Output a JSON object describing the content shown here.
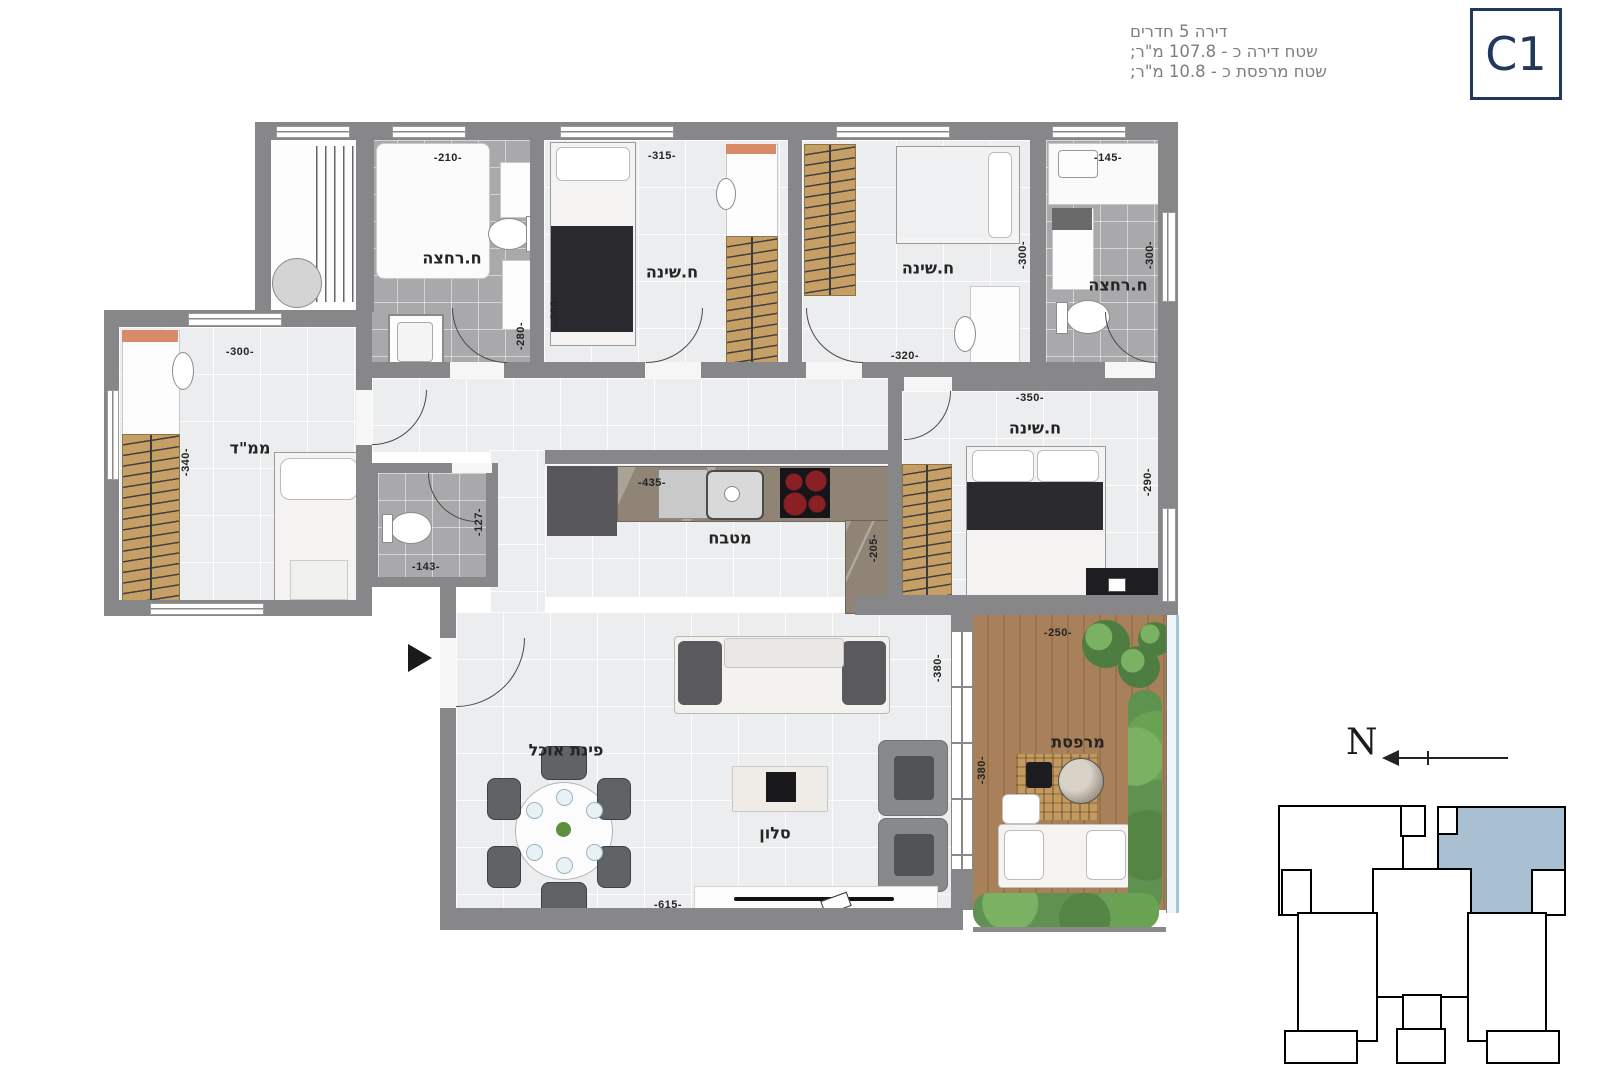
{
  "header": {
    "unit_code": "C1",
    "lines": [
      "דירה 5 חדרים",
      "שטח דירה כ - 107.8 מ\"ר;",
      "שטח מרפסת כ - 10.8 מ\"ר;"
    ]
  },
  "plan": {
    "room_labels": {
      "bath1": "ח.רחצה",
      "bed1": "ח.שינה",
      "bed2": "ח.שינה",
      "bath2": "ח.רחצה",
      "mamad": "ממ\"ד",
      "master": "ח.שינה",
      "kitchen": "מטבח",
      "dining": "פינת אוכל",
      "living": "סלון",
      "balcony": "מרפסת"
    },
    "dims": {
      "bath1_w": "-210-",
      "bath1_h": "-280-",
      "bed1_w": "-315-",
      "bed1_h": "-300-",
      "bed2_w": "-320-",
      "bed2_h": "-300-",
      "bath2_w": "-145-",
      "bath2_h": "-300-",
      "mamad_w": "-300-",
      "mamad_h": "-340-",
      "wc_w": "-143-",
      "wc_h": "-127-",
      "kitchen_w": "-435-",
      "kitchen_h": "-205-",
      "master_w": "-350-",
      "master_h": "-290-",
      "living_w": "-615-",
      "living_h": "-380-",
      "balcony_w": "-250-",
      "balcony_h": "-380-"
    },
    "compass": {
      "north_label": "N"
    }
  },
  "colors": {
    "wall": "#878789",
    "navy": "#21375d",
    "key_unit_fill": "#a9c0d2",
    "wood": "#c69f67",
    "deck": "#a8815a",
    "green": "#5f9150"
  }
}
